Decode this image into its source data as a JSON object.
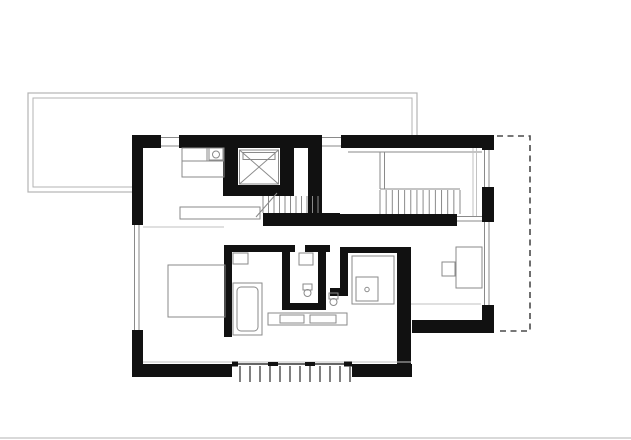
{
  "document": {
    "kind": "architectural-floor-plan",
    "visible_text": []
  },
  "colors": {
    "wall": "#111111",
    "thin": "#8a8a8a",
    "faint": "#c2c2c2",
    "dark": "#333333",
    "baluster": "#555555",
    "terrace": "#b3b3b3",
    "dash": "#4a4a4a",
    "bg": "#ffffff",
    "baseline": "#d9d9d9"
  },
  "canvas": {
    "w": 631,
    "h": 440
  },
  "terrace": {
    "outer": [
      28,
      93,
      389,
      99
    ],
    "inner": [
      33,
      98,
      379,
      89
    ]
  },
  "footprint_path": "M132,135 H494 V333 H411 V377 H132 Z",
  "walls": [
    {
      "name": "ext-wall-top",
      "r": [
        132,
        135,
        362,
        13
      ]
    },
    {
      "name": "ext-wall-left-upper",
      "r": [
        132,
        135,
        11,
        90
      ]
    },
    {
      "name": "ext-wall-left-lower",
      "r": [
        132,
        330,
        11,
        47
      ]
    },
    {
      "name": "ext-wall-bottom-left",
      "r": [
        132,
        364,
        100,
        13
      ]
    },
    {
      "name": "ext-wall-bottom-right",
      "r": [
        352,
        364,
        60,
        13
      ]
    },
    {
      "name": "ext-wall-right-top",
      "r": [
        482,
        140,
        12,
        10
      ]
    },
    {
      "name": "ext-wall-right-mid",
      "r": [
        482,
        187,
        12,
        35
      ]
    },
    {
      "name": "ext-wall-right-bottom",
      "r": [
        482,
        305,
        12,
        28
      ]
    },
    {
      "name": "ext-wall-step",
      "r": [
        412,
        320,
        82,
        13
      ]
    },
    {
      "name": "ext-wall-right-center-vertical",
      "r": [
        397,
        247,
        14,
        128
      ]
    },
    {
      "name": "shaft-pillar-left",
      "r": [
        223,
        148,
        15,
        48
      ]
    },
    {
      "name": "shaft-pillar-right",
      "r": [
        280,
        148,
        14,
        48
      ]
    },
    {
      "name": "shaft-wall-bottom",
      "r": [
        223,
        185,
        71,
        11
      ]
    },
    {
      "name": "upper-rooms-divider-wall",
      "r": [
        308,
        148,
        14,
        66
      ]
    },
    {
      "name": "stair-lower-wall",
      "r": [
        263,
        213,
        77,
        13
      ]
    },
    {
      "name": "spine-wall",
      "r": [
        340,
        214,
        117,
        12
      ]
    },
    {
      "name": "bath-wall-left",
      "r": [
        224,
        245,
        8,
        92
      ]
    },
    {
      "name": "bath-wall-top-1",
      "r": [
        224,
        245,
        71,
        7
      ]
    },
    {
      "name": "bath-wall-top-2",
      "r": [
        305,
        245,
        25,
        7
      ]
    },
    {
      "name": "bath-wall-mid-vertical",
      "r": [
        282,
        252,
        8,
        58
      ]
    },
    {
      "name": "bath-wall-bottom",
      "r": [
        282,
        303,
        44,
        7
      ]
    },
    {
      "name": "bath-wall-right-vertical",
      "r": [
        318,
        252,
        8,
        51
      ]
    },
    {
      "name": "shower-wall-left",
      "r": [
        340,
        247,
        8,
        48
      ]
    },
    {
      "name": "shower-wall-top",
      "r": [
        340,
        247,
        57,
        6
      ]
    },
    {
      "name": "wc-niche-wall",
      "r": [
        330,
        288,
        18,
        8
      ]
    }
  ],
  "windows": [
    {
      "name": "window-top-1",
      "clear": [
        161,
        134,
        18,
        15
      ],
      "glaze": [
        [
          161,
          137.5,
          179,
          137.5
        ],
        [
          161,
          146,
          179,
          146
        ]
      ]
    },
    {
      "name": "window-top-2",
      "clear": [
        322,
        134,
        19,
        15
      ],
      "glaze": [
        [
          322,
          137.5,
          341,
          137.5
        ],
        [
          322,
          146,
          341,
          146
        ]
      ]
    },
    {
      "name": "window-left",
      "clear": [
        131,
        225,
        13,
        105
      ],
      "glaze": [
        [
          134.5,
          225,
          134.5,
          330
        ],
        [
          139,
          225,
          139,
          330
        ]
      ]
    },
    {
      "name": "window-right-1",
      "clear": [
        481,
        150,
        14,
        37
      ],
      "glaze": [
        [
          484.5,
          150,
          484.5,
          187
        ],
        [
          489,
          150,
          489,
          187
        ]
      ]
    },
    {
      "name": "window-right-2",
      "clear": [
        481,
        222,
        14,
        83
      ],
      "glaze": [
        [
          484.5,
          222,
          484.5,
          305
        ],
        [
          489,
          222,
          489,
          305
        ]
      ]
    }
  ],
  "furniture": [
    {
      "name": "kitchen-counter",
      "r": [
        182,
        148,
        42,
        13
      ]
    },
    {
      "name": "kitchen-cabinet",
      "r": [
        182,
        161,
        42,
        16
      ]
    },
    {
      "name": "kitchen-sink-box",
      "r": [
        209,
        148,
        14,
        12
      ]
    },
    {
      "name": "sideboard",
      "r": [
        180,
        207,
        80,
        12
      ]
    },
    {
      "name": "bed",
      "r": [
        168,
        265,
        57,
        52
      ]
    },
    {
      "name": "bathtub",
      "r": [
        233,
        283,
        29,
        52
      ]
    },
    {
      "name": "bathtub-inner",
      "r": [
        237,
        287,
        21,
        44
      ],
      "rx": 4
    },
    {
      "name": "bath-cabinet-1",
      "r": [
        233,
        253,
        15,
        11
      ]
    },
    {
      "name": "bath-cabinet-2",
      "r": [
        299,
        253,
        14,
        12
      ]
    },
    {
      "name": "vanity-counter",
      "r": [
        268,
        313,
        79,
        12
      ]
    },
    {
      "name": "vanity-basin-1",
      "r": [
        280,
        315,
        24,
        8
      ]
    },
    {
      "name": "vanity-basin-2",
      "r": [
        310,
        315,
        26,
        8
      ]
    },
    {
      "name": "shower-enclosure",
      "r": [
        352,
        256,
        42,
        48
      ]
    },
    {
      "name": "shower-tray",
      "r": [
        356,
        277,
        22,
        24
      ]
    },
    {
      "name": "desk",
      "r": [
        456,
        247,
        26,
        41
      ]
    },
    {
      "name": "desk-chair",
      "r": [
        442,
        262,
        13,
        14
      ]
    },
    {
      "name": "toilet-1-tank",
      "r": [
        303,
        284,
        9,
        6
      ]
    },
    {
      "name": "toilet-2-tank",
      "r": [
        329,
        293,
        9,
        6
      ]
    }
  ],
  "fixtures_circles": [
    {
      "name": "kitchen-sink",
      "c": [
        216,
        154.5,
        3.5
      ]
    },
    {
      "name": "toilet-1-bowl",
      "c": [
        307.5,
        293,
        3.5
      ]
    },
    {
      "name": "toilet-2-bowl",
      "c": [
        333.5,
        302,
        3.5
      ]
    },
    {
      "name": "shower-drain",
      "c": [
        367,
        289.5,
        2.2
      ]
    }
  ],
  "stairs": [
    {
      "name": "main-stair-treads",
      "x0": 263,
      "x1": 318,
      "n": 11,
      "y0": 196,
      "y1": 213
    },
    {
      "name": "upper-stair-treads",
      "x0": 380,
      "x1": 460,
      "n": 14,
      "y0": 190,
      "y1": 214
    }
  ],
  "shaft": {
    "frame": [
      239.5,
      150,
      39,
      34
    ],
    "car": [
      243,
      152.5,
      32,
      7
    ],
    "diagonals": [
      [
        239.5,
        150,
        278.5,
        184
      ],
      [
        278.5,
        150,
        239.5,
        184
      ]
    ]
  },
  "lines": [
    {
      "name": "main-stair-break-line",
      "p": [
        256,
        217,
        277,
        193
      ],
      "c": "thin",
      "w": 1
    },
    {
      "name": "upper-landing-edge",
      "p": [
        348,
        152,
        482,
        152
      ],
      "c": "thin",
      "w": 1
    },
    {
      "name": "upper-landing-side-1",
      "p": [
        380,
        152,
        380,
        189
      ],
      "c": "thin",
      "w": 1
    },
    {
      "name": "upper-landing-side-2",
      "p": [
        384.5,
        152,
        384.5,
        189
      ],
      "c": "thin",
      "w": 1
    },
    {
      "name": "upper-stair-rail",
      "p": [
        380,
        189,
        460,
        189
      ],
      "c": "thin",
      "w": 1
    },
    {
      "name": "door-track-1",
      "p": [
        473,
        148,
        473,
        217
      ],
      "c": "faint",
      "w": 1
    },
    {
      "name": "door-track-2",
      "p": [
        476.5,
        148,
        476.5,
        217
      ],
      "c": "faint",
      "w": 1
    },
    {
      "name": "right-room-sill-1",
      "p": [
        457,
        216.5,
        482,
        216.5
      ],
      "c": "thin",
      "w": 1
    },
    {
      "name": "right-room-sill-2",
      "p": [
        457,
        221,
        482,
        221
      ],
      "c": "thin",
      "w": 1
    },
    {
      "name": "floor-edge-bottom",
      "p": [
        143,
        362,
        411,
        362
      ],
      "c": "faint",
      "w": 1
    },
    {
      "name": "floor-edge-right-room",
      "p": [
        411,
        304,
        481,
        304
      ],
      "c": "faint",
      "w": 1
    },
    {
      "name": "left-room-divider-line",
      "p": [
        143,
        227,
        224,
        227
      ],
      "c": "faint",
      "w": 1
    },
    {
      "name": "counter-divider",
      "p": [
        207,
        148,
        207,
        161
      ],
      "c": "thin",
      "w": 1
    },
    {
      "name": "page-baseline",
      "p": [
        0,
        438,
        631,
        438
      ],
      "c": "baseline",
      "w": 2
    }
  ],
  "railing": {
    "top_line": {
      "p": [
        232,
        364,
        352,
        364
      ],
      "c": "dark",
      "w": 1.5
    },
    "mullions": [
      [
        232,
        361.5,
        6,
        5
      ],
      [
        268,
        362,
        10,
        4
      ],
      [
        305,
        362,
        10,
        4
      ],
      [
        344,
        361.5,
        8,
        5
      ]
    ],
    "balusters": {
      "x0": 240,
      "x1": 350,
      "n": 12,
      "y0": 366,
      "y1": 382,
      "c": "baluster",
      "w": 1.5
    }
  },
  "dashed_extension": {
    "path": "M497,136 H530 V331 H497",
    "dasharray": "6 4.5",
    "w": 1.6
  }
}
